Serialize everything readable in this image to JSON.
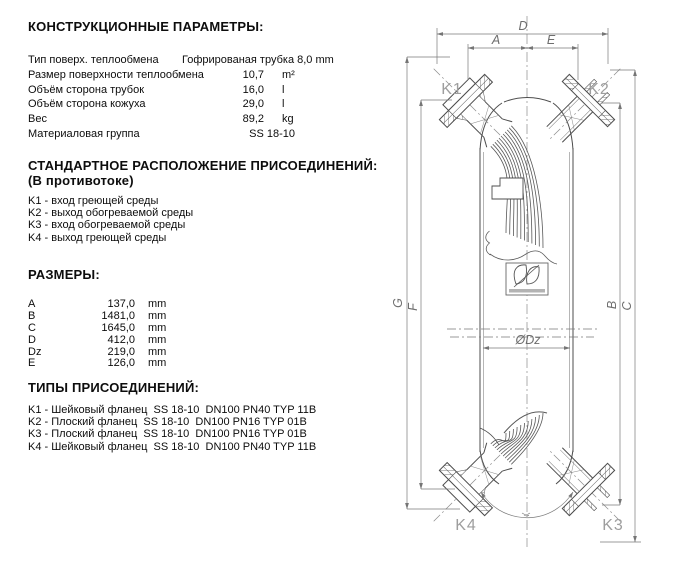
{
  "sections": {
    "construction": {
      "title": "КОНСТРУКЦИОННЫЕ ПАРАМЕТРЫ:",
      "rows": [
        {
          "label": "Тип поверх. теплообмена",
          "value": "Гофрированая трубка 8,0 mm",
          "unit": ""
        },
        {
          "label": "Размер поверхности теплообмена",
          "value": "10,7",
          "unit": "m²"
        },
        {
          "label": "Объём сторона трубок",
          "value": "16,0",
          "unit": "l"
        },
        {
          "label": "Объём сторона кожуха",
          "value": "29,0",
          "unit": "l"
        },
        {
          "label": "Вес",
          "value": "89,2",
          "unit": "kg"
        },
        {
          "label": "Материаловая группа",
          "value": "SS 18-10",
          "unit": ""
        }
      ]
    },
    "arrangement": {
      "title": "СТАНДАРТНОЕ РАСПОЛОЖЕНИЕ ПРИСОЕДИНЕНИЙ:",
      "subtitle": "(В противотоке)",
      "items": [
        "K1 - вход греющей среды",
        "K2 - выход обогреваемой среды",
        "K3 - вход обогреваемой среды",
        "K4 - выход греющей среды"
      ]
    },
    "dimensions": {
      "title": "РАЗМЕРЫ:",
      "rows": [
        {
          "name": "A",
          "value": "137,0",
          "unit": "mm"
        },
        {
          "name": "B",
          "value": "1481,0",
          "unit": "mm"
        },
        {
          "name": "C",
          "value": "1645,0",
          "unit": "mm"
        },
        {
          "name": "D",
          "value": "412,0",
          "unit": "mm"
        },
        {
          "name": "Dz",
          "value": "219,0",
          "unit": "mm"
        },
        {
          "name": "E",
          "value": "126,0",
          "unit": "mm"
        }
      ]
    },
    "connections": {
      "title": "ТИПЫ ПРИСОЕДИНЕНИЙ:",
      "items": [
        "K1 - Шейковый фланец  SS 18-10  DN100 PN40 TYP 11B",
        "K2 - Плоский фланец  SS 18-10  DN100 PN16 TYP 01B",
        "K3 - Плоский фланец  SS 18-10  DN100 PN16 TYP 01B",
        "K4 - Шейковый фланец  SS 18-10  DN100 PN40 TYP 11B"
      ]
    }
  },
  "drawing": {
    "ports": {
      "k1": "K1",
      "k2": "K2",
      "k3": "K3",
      "k4": "K4"
    },
    "dims": {
      "d": "D",
      "a": "A",
      "e": "E",
      "g": "G",
      "f": "F",
      "b": "B",
      "c": "C",
      "dz": "ØDz"
    }
  },
  "colors": {
    "line": "#4d4d4d",
    "dim_line": "#7a7a7a",
    "port_label": "#9e9e9e",
    "text": "#0d0d0d"
  }
}
